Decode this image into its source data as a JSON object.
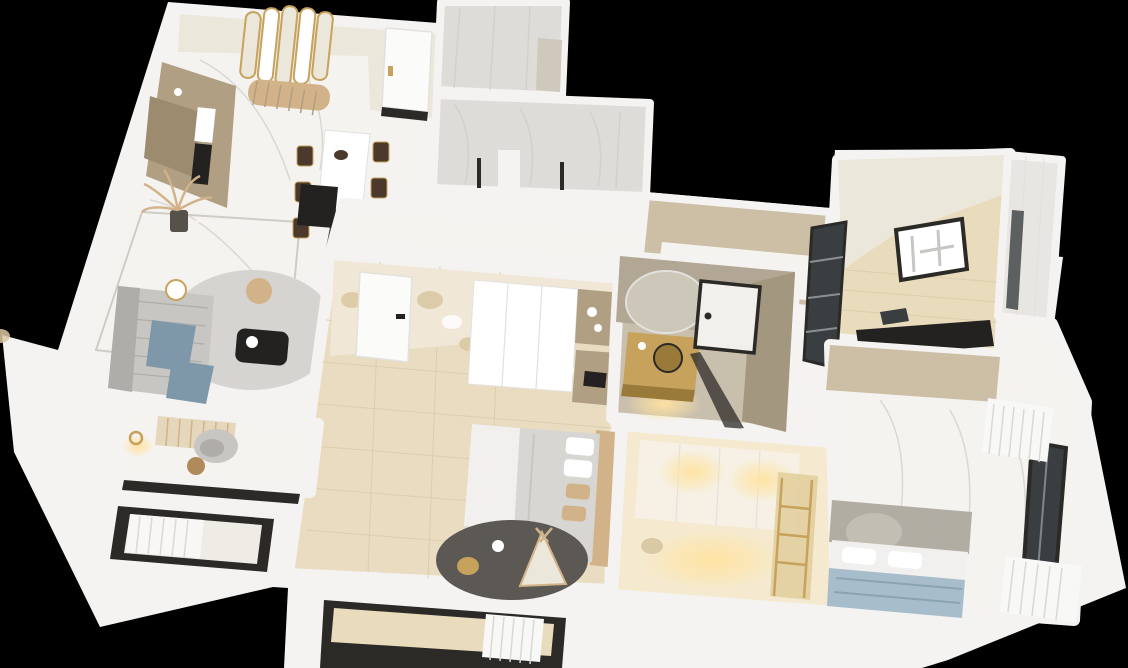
{
  "scene": {
    "description": "3D axonometric dollhouse rendering of an apartment floor plan on a black background",
    "style": "photoreal top-down 3D render, white walls, cream and gold interior"
  },
  "palette": {
    "bg": "#000000",
    "wall": "#f4f3f1",
    "wall_shade": "#e3e1dd",
    "cream_wall": "#ece7db",
    "tan_wall": "#cdbfa6",
    "cabinet_tan": "#b09f83",
    "cabinet_tan_dark": "#9c8b6f",
    "wallpaper": "#f0e7d7",
    "wallpaper_floral": "#d9c7a0",
    "floor_marble": "#f5f3f0",
    "marble_vein": "#cfccc6",
    "floor_tile": "#e9dcc0",
    "tile_line": "#d9cba8",
    "floor_travertine": "#c9bfad",
    "travertine_wall": "#b2a794",
    "travertine_wall_dark": "#a3977f",
    "floor_wood": "#e9dcbd",
    "floor_warm": "#f5ead0",
    "gray_marble_wall": "#dddcd8",
    "door_white": "#fbfbf9",
    "black": "#232220",
    "dark_wood": "#4b3a2c",
    "glass_dark": "#3a3e41",
    "frame_dark": "#2c2a27",
    "gold": "#c7a25c",
    "gold_deep": "#9a7a38",
    "glow": "#ffe3a1",
    "sofa": "#c7c6c3",
    "sofa_dark": "#aeadaa",
    "throw_blue": "#7e98aa",
    "rug_light": "#d6d4d0",
    "rug_dark": "#5c5955",
    "bed_white": "#f1f0ee",
    "bed_gray": "#d7d6d3",
    "pillow_tan": "#d2b288",
    "bed_blue": "#a7bdcb",
    "bed_blue_line": "#8aa4b4",
    "headboard_gray": "#b2ada3",
    "headboard_arch": "#c3beb4",
    "curtain": "#f8f8f6",
    "curtain_line": "#d9d8d4",
    "mirror_silver": "#cdc7ba",
    "white": "#ffffff"
  },
  "rooms": [
    {
      "name": "living-dining-kitchen",
      "floor": "white marble with decorative border",
      "contents": [
        "tan kitchen cabinets with appliances",
        "arched gold-framed mirror panel with channel-tufted bench",
        "white stone dining table with dark wood chairs",
        "potted palm",
        "black media console",
        "gray sofa with blue throws",
        "round gray rug",
        "black coffee table",
        "tan pouf",
        "gold side table"
      ]
    },
    {
      "name": "entry-hall",
      "floor": "white marble",
      "contents": [
        "white entry door with gold handle",
        "dark floor mat"
      ]
    },
    {
      "name": "shower-room-top",
      "walls": "white-gray marble",
      "contents": []
    },
    {
      "name": "marble-bathroom-top",
      "walls": "white-gray marble",
      "contents": [
        "glass screen",
        "fixtures"
      ]
    },
    {
      "name": "corridor",
      "floor": "white marble",
      "walls": "tan plaster"
    },
    {
      "name": "master-bedroom",
      "floor": "beige tile",
      "contents": [
        "floral wallpaper wall",
        "white door",
        "white wardrobe",
        "tan shelf nook",
        "vanity desk with laptop",
        "white stool",
        "bed with gray-white duvet and tan pillows",
        "dark round rug",
        "play teepee",
        "floor lamp"
      ]
    },
    {
      "name": "bathroom-gold",
      "walls": "travertine",
      "contents": [
        "round antique mirror",
        "gold vanity with vessel sink",
        "black-framed frosted glass door"
      ]
    },
    {
      "name": "kids-room",
      "floor": "warm cream",
      "contents": [
        "white wardrobe with warm downlights",
        "loft bed with wood-gold ladder",
        "stool"
      ]
    },
    {
      "name": "study",
      "floor": "light wood planks",
      "contents": [
        "framed artwork",
        "black desk with laptop",
        "dark glass partition",
        "white sliding wardrobe"
      ]
    },
    {
      "name": "closet",
      "contents": [
        "white sliding panels with smoked glass"
      ]
    },
    {
      "name": "bedroom-right",
      "floor": "white marble",
      "contents": [
        "gray paneled headboard wall with arch motif",
        "bed with blue-gray duvet and white pillows",
        "dark-framed window with sheer white curtains"
      ]
    },
    {
      "name": "balcony-left",
      "contents": [
        "dark window frame",
        "white sheer curtain"
      ]
    },
    {
      "name": "balcony-center",
      "floor": "light wood",
      "contents": [
        "dark window frame",
        "white sheer curtain"
      ]
    }
  ]
}
